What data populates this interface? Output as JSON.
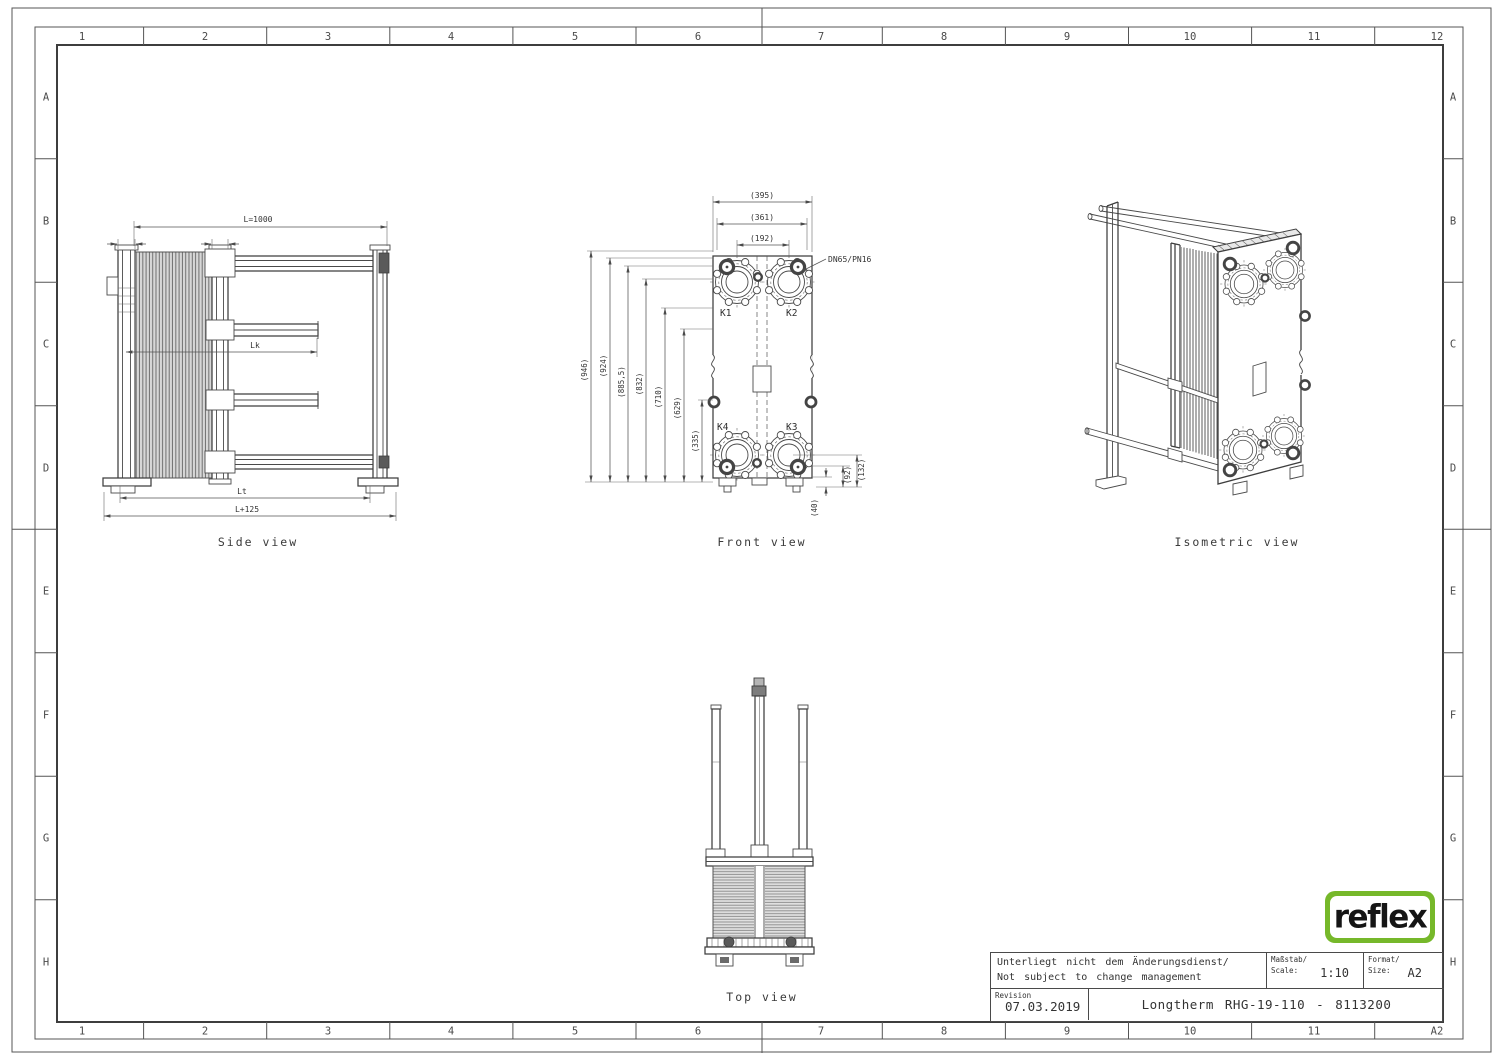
{
  "frame": {
    "top": [
      "1",
      "2",
      "3",
      "4",
      "5",
      "6",
      "7",
      "8",
      "9",
      "10",
      "11",
      "12"
    ],
    "bottom": [
      "1",
      "2",
      "3",
      "4",
      "5",
      "6",
      "7",
      "8",
      "9",
      "10",
      "11",
      "A2"
    ],
    "left": [
      "A",
      "B",
      "C",
      "D",
      "E",
      "F",
      "G",
      "H"
    ],
    "right": [
      "A",
      "B",
      "C",
      "D",
      "E",
      "F",
      "G",
      "H"
    ]
  },
  "side_view": {
    "label": "Side view",
    "dims": {
      "length": "L=1000",
      "lk": "Lk",
      "lt": "Lt",
      "l_plus": "L+125"
    }
  },
  "front_view": {
    "label": "Front view",
    "dims_top": [
      "(395)",
      "(361)",
      "(192)"
    ],
    "dims_left": [
      "(946)",
      "(924)",
      "(885,5)",
      "(832)",
      "(710)",
      "(629)",
      "(335)"
    ],
    "dims_right": [
      "(132)",
      "(92)",
      "(40)"
    ],
    "ports": [
      "K1",
      "K2",
      "K3",
      "K4"
    ],
    "connection_note": "DN65/PN16"
  },
  "isometric_view": {
    "label": "Isometric view"
  },
  "top_view": {
    "label": "Top view"
  },
  "title_block": {
    "note_line1": "Unterliegt nicht dem Änderungsdienst/",
    "note_line2": "Not subject to change management",
    "scale_label_line1": "Maßstab/",
    "scale_label_line2": "Scale:",
    "scale_value": "1:10",
    "format_label_line1": "Format/",
    "format_label_line2": "Size:",
    "format_value": "A2",
    "revision_label": "Revision",
    "revision_date": "07.03.2019",
    "drawing_title": "Longtherm RHG-19-110 - 8113200"
  },
  "logo": {
    "text": "reflex",
    "color": "#76b82a"
  }
}
